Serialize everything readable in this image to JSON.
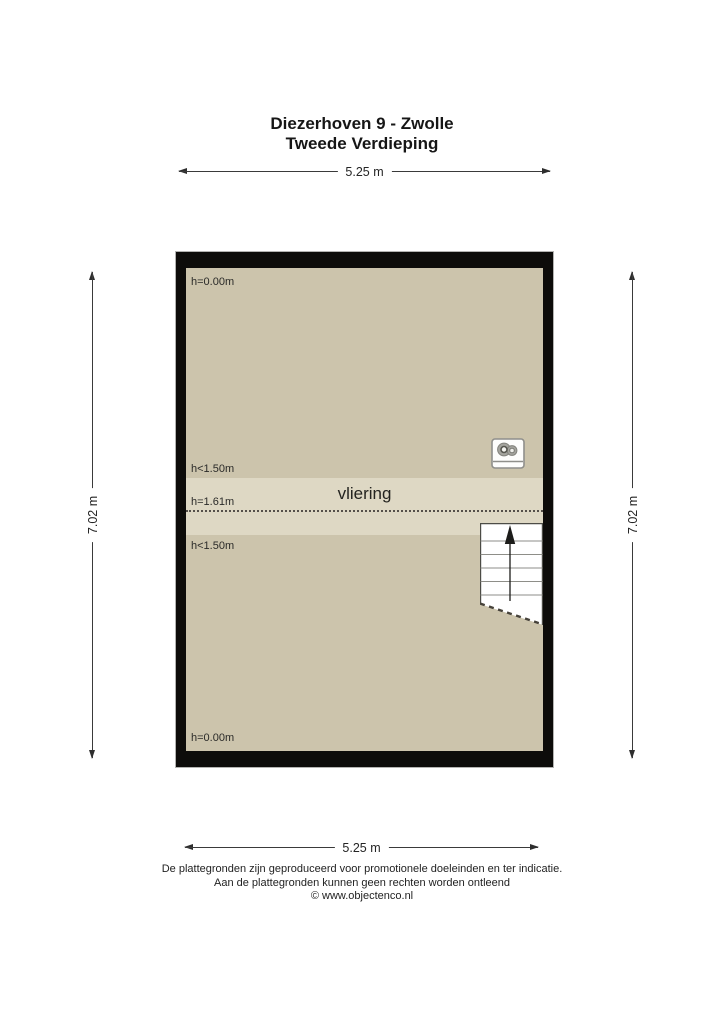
{
  "page": {
    "title_line1": "Diezerhoven 9 - Zwolle",
    "title_line2": "Tweede Verdieping"
  },
  "dimensions": {
    "width_top": "5.25 m",
    "width_bottom": "5.25 m",
    "height_left": "7.02 m",
    "height_right": "7.02 m"
  },
  "floorplan": {
    "room_label": "vliering",
    "height_labels": {
      "top_left": "h=0.00m",
      "upper": "h<1.50m",
      "ridge": "h=1.61m",
      "lower": "h<1.50m",
      "bottom_left": "h=0.00m"
    },
    "icons": {
      "ventilation_unit": "ventilation-unit-icon",
      "stairs": "stairs-up-icon"
    },
    "colors": {
      "wall": "#0d0c0a",
      "floor": "#ccc4ac",
      "vliering_band": "#ded8c4",
      "stairs_fill": "#ffffff"
    }
  },
  "footer": {
    "line1": "De plattegronden zijn geproduceerd voor promotionele doeleinden en ter indicatie.",
    "line2": "Aan de plattegronden kunnen geen rechten worden ontleend",
    "line3": "© www.objectenco.nl"
  }
}
